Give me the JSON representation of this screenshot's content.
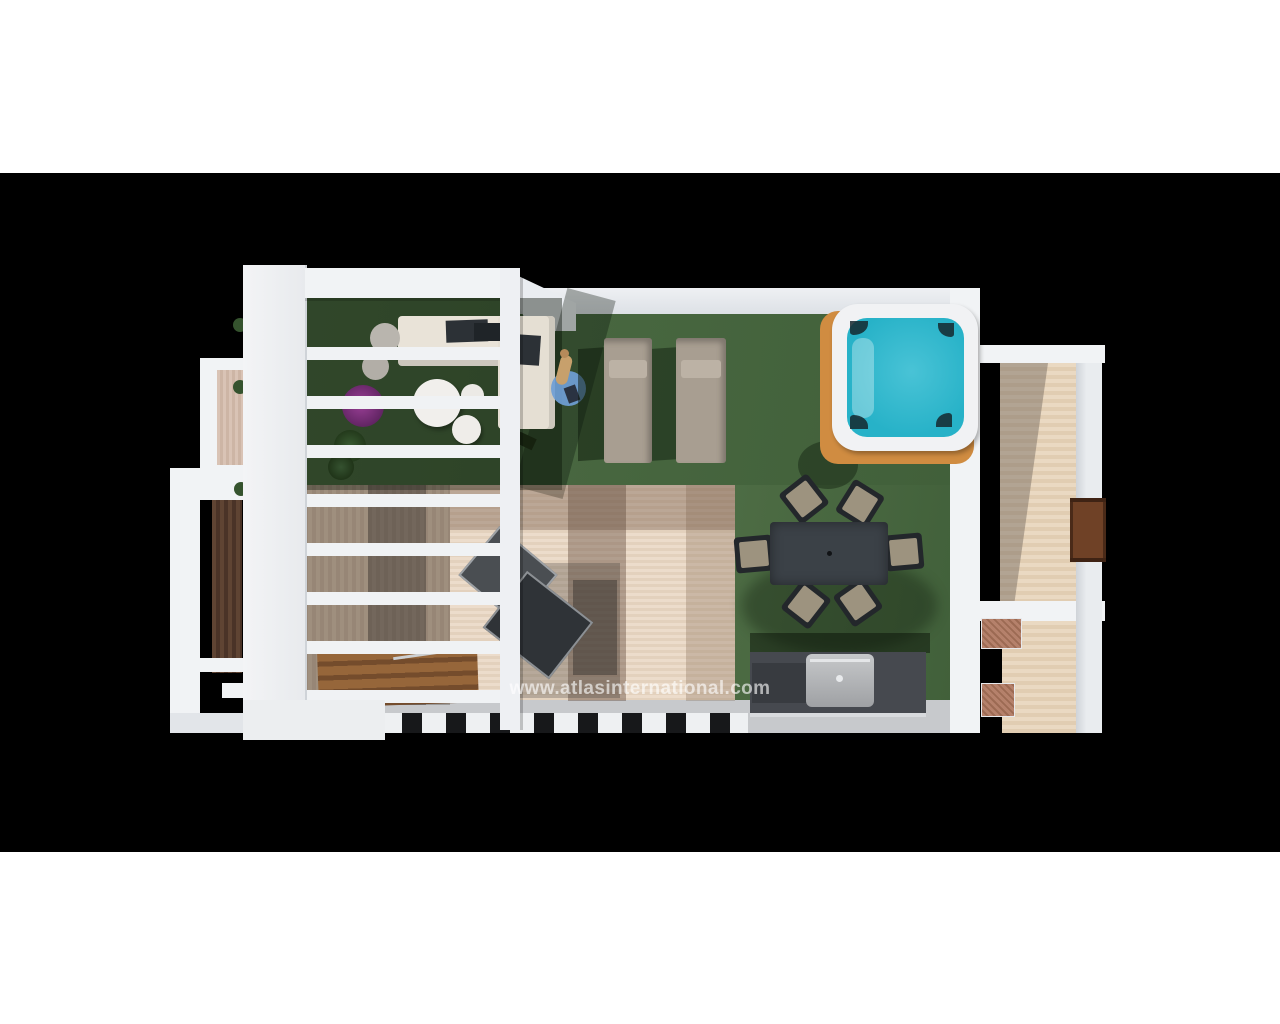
{
  "watermark": {
    "text": "www.atlasinternational.com"
  },
  "scene": {
    "type": "3d-top-view-render",
    "subject": "roof terrace with pergola, lawn, hot tub, sun loungers, dining set and bbq"
  },
  "colors": {
    "page": "#ffffff",
    "band": "#000000",
    "white": "#f1f3f5",
    "white_dim": "#e2e5e9",
    "lawn": "#4d6c44",
    "lawn_dark2": "#41603a",
    "rug": "#ecdccb",
    "deck": "#cdb8a4",
    "deck_right": "#ead9c2",
    "water": "#27b2c8",
    "tub_frame": "#f1f2f4",
    "tub_base": "#d08c41",
    "table": "#3b4147",
    "seat": "#9d937f",
    "bbq": "#46494f",
    "hood": "#b8babc",
    "door": "#6f4126",
    "brick": "#b5816b",
    "stairs": "#96663a",
    "blue_rug": "#6f9ed6",
    "purple": "#9a3f96",
    "green": "#35532e",
    "lounger": "#a89e91",
    "sofa": "#e9e3d8",
    "gray_strip": "#c7c9cc",
    "rail_dark": "#17181a",
    "watermark": "rgba(255,255,255,0.62)"
  }
}
